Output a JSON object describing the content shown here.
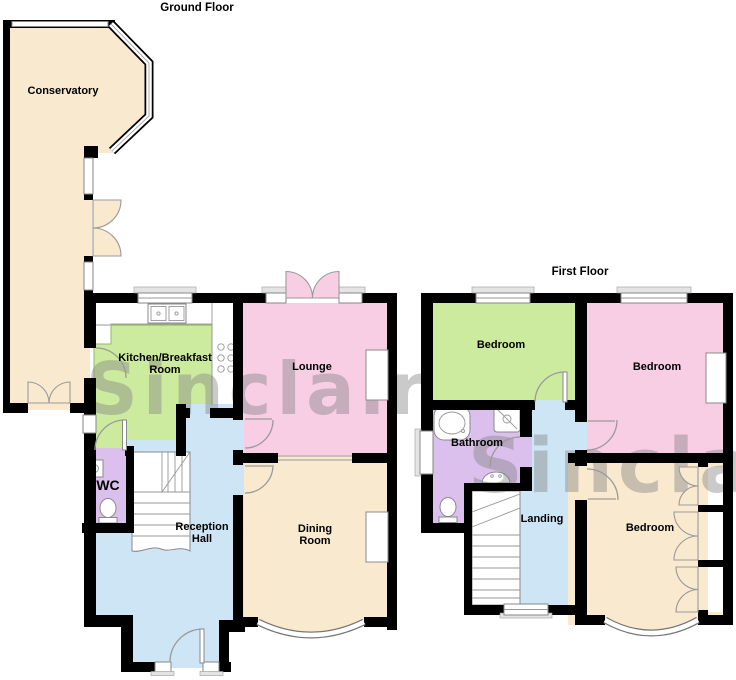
{
  "watermark": {
    "text": "Sinclair"
  },
  "ground_floor": {
    "title": "Ground Floor",
    "rooms": {
      "conservatory": {
        "label": "Conservatory"
      },
      "kitchen": {
        "line1": "Kitchen/Breakfast",
        "line2": "Room"
      },
      "lounge": {
        "label": "Lounge"
      },
      "wc": {
        "label": "WC"
      },
      "reception_hall": {
        "line1": "Reception",
        "line2": "Hall"
      },
      "dining_room": {
        "line1": "Dining",
        "line2": "Room"
      }
    }
  },
  "first_floor": {
    "title": "First Floor",
    "rooms": {
      "bedroom_left": {
        "label": "Bedroom"
      },
      "bedroom_right": {
        "label": "Bedroom"
      },
      "bedroom_rear": {
        "label": "Bedroom"
      },
      "bathroom": {
        "label": "Bathroom"
      },
      "landing": {
        "label": "Landing"
      }
    }
  },
  "colors": {
    "cream": "#F9E9CF",
    "green": "#CDEB9E",
    "pink": "#F8CEE5",
    "blue": "#CEE5F6",
    "purple": "#DBC0ED",
    "wall": "#000000",
    "watermark_grey": "#828282"
  }
}
